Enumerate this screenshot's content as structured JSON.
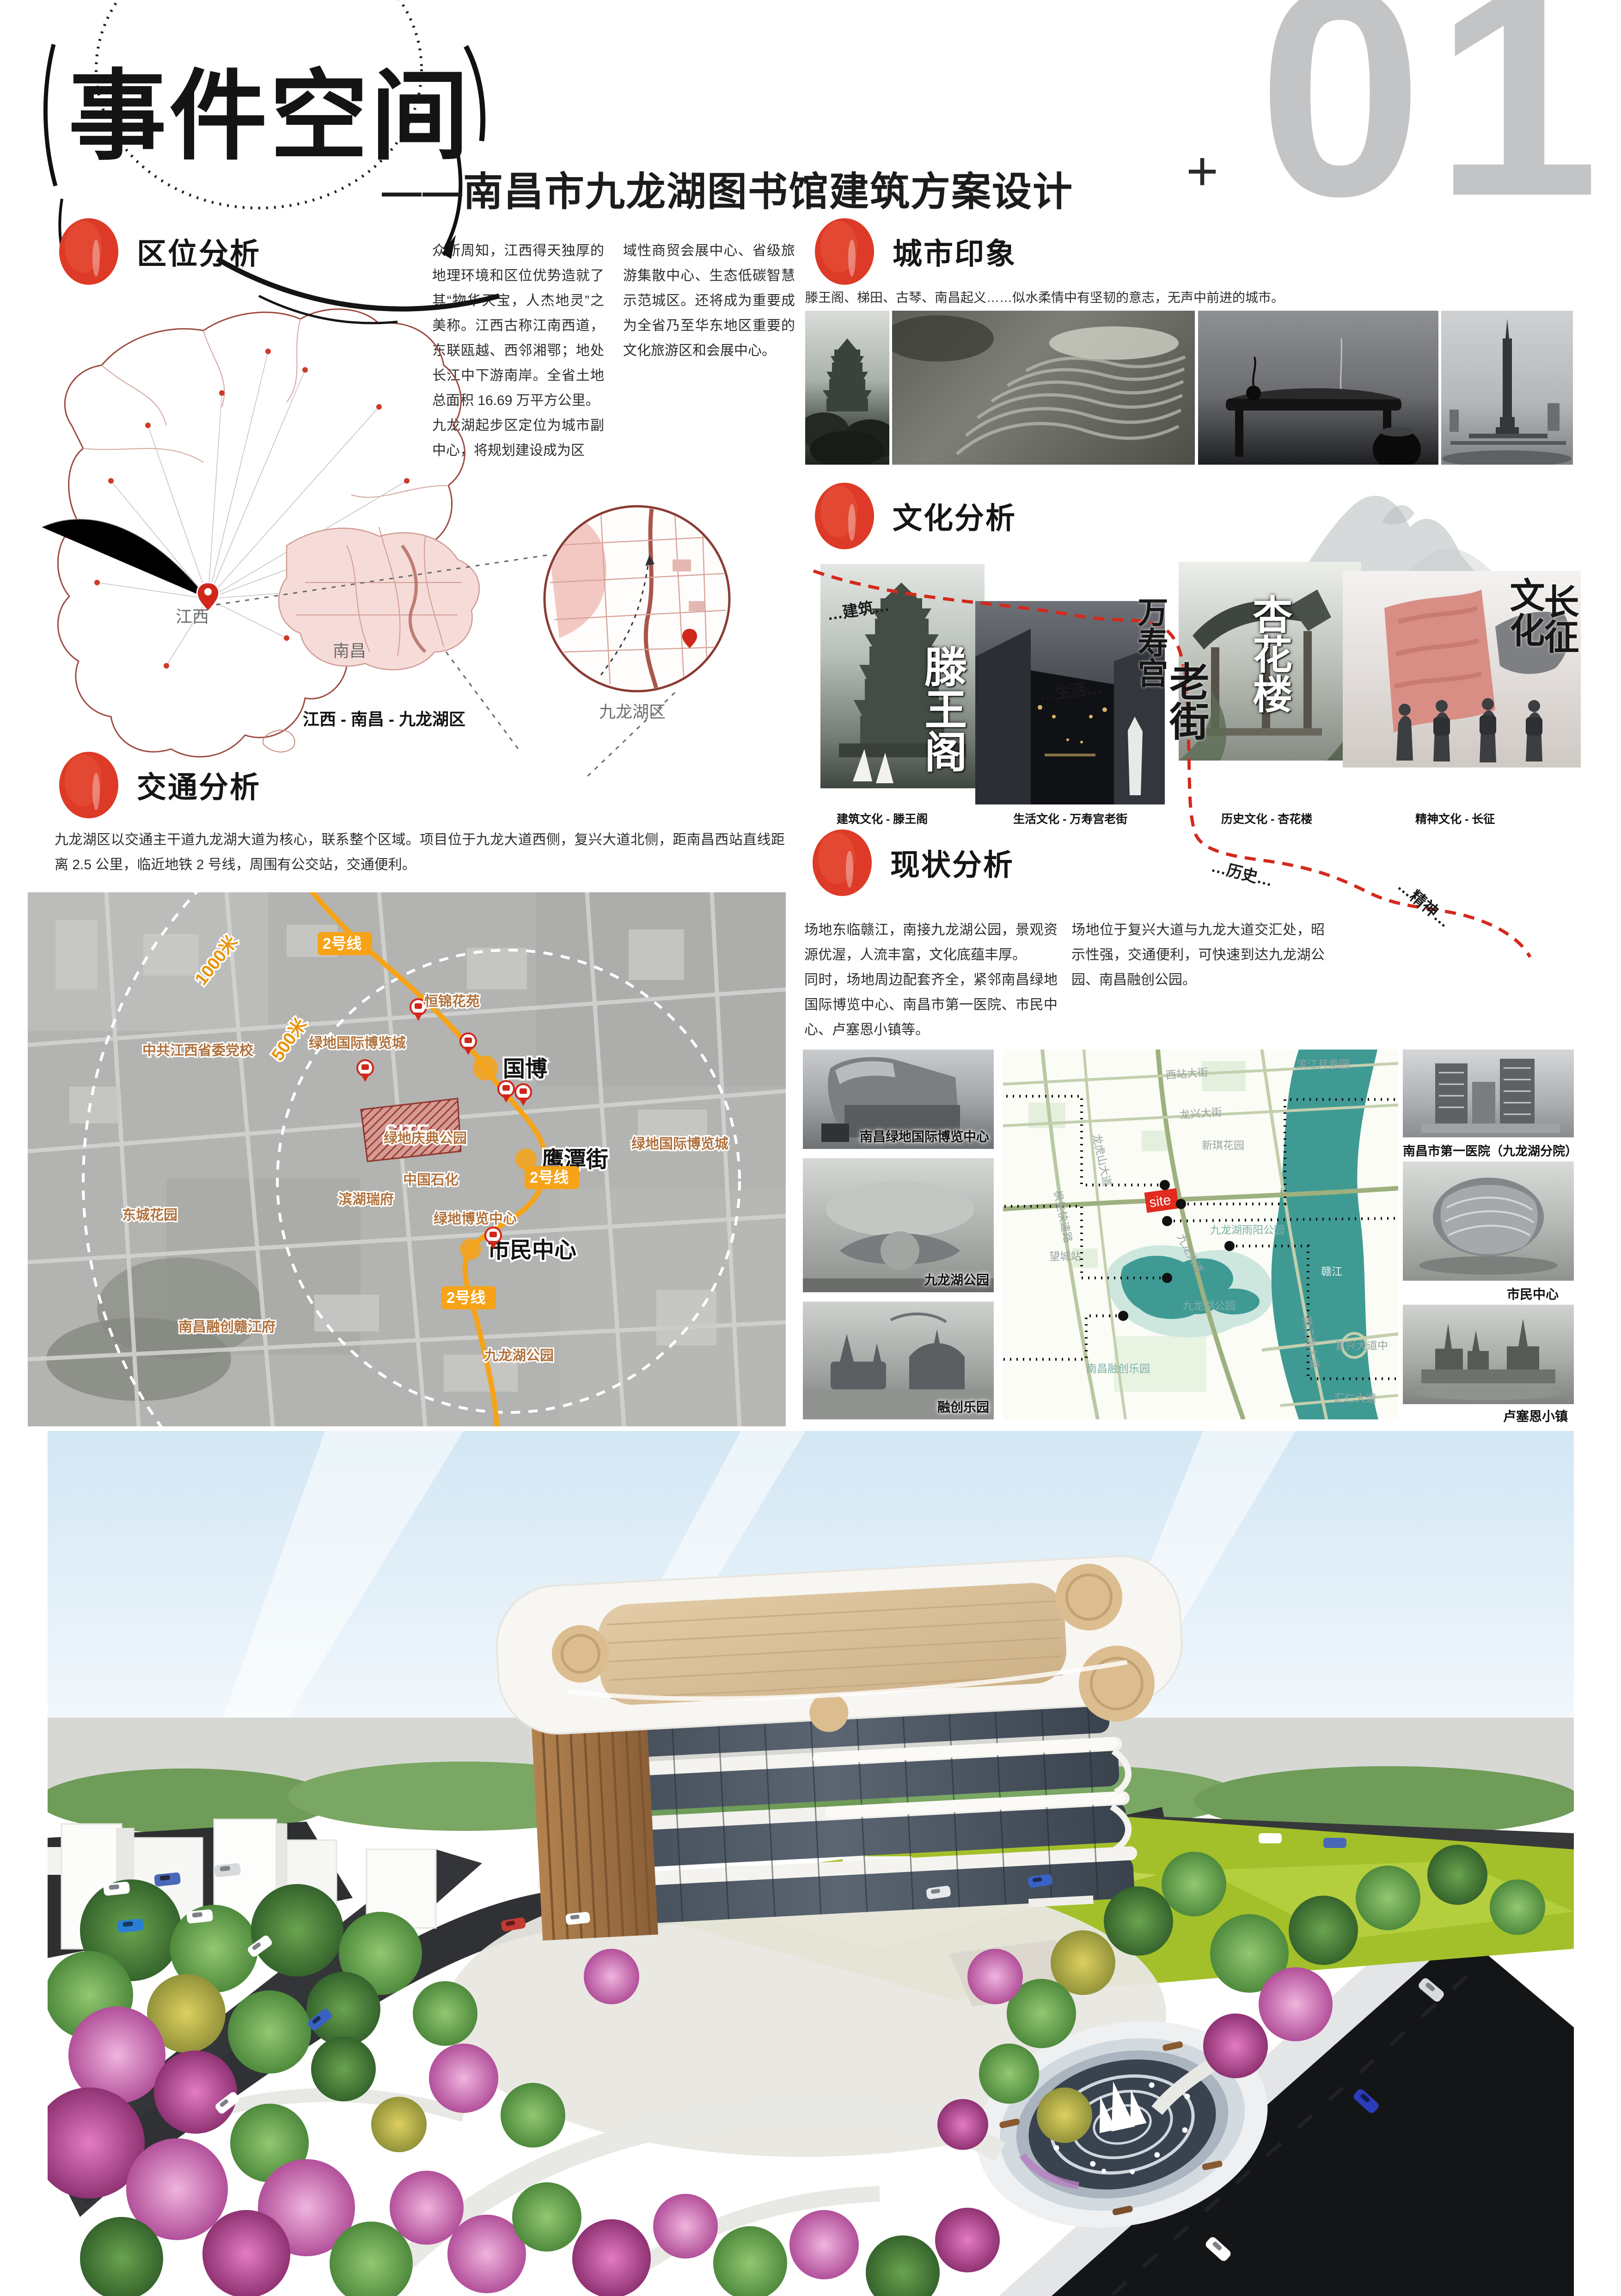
{
  "page": {
    "badge": "01",
    "plus_mark": "+"
  },
  "title": {
    "main": "事件空间",
    "subtitle": "——南昌市九龙湖图书馆建筑方案设计"
  },
  "location": {
    "heading": "区位分析",
    "col1a": "众所周知，江西得天独厚的地理环境和区位优势造就了其“物华天宝，人杰地灵”之美称。江西古称江南西道，东联瓯越、西邻湘鄂；地处长江中下游南岸。全省土地总面积 16.69 万平方公里。",
    "col1b": "九龙湖起步区定位为城市副中心，将规划建设成为区",
    "col2": "域性商贸会展中心、省级旅游集散中心、生态低碳智慧示范城区。还将成为重要成为全省乃至华东地区重要的文化旅游区和会展中心。",
    "map": {
      "jiangxi": "江西",
      "nanchang": "南昌",
      "jiulonghu": "九龙湖区",
      "caption": "江西 - 南昌 - 九龙湖区"
    }
  },
  "impression": {
    "heading": "城市印象",
    "desc": "滕王阁、梯田、古琴、南昌起义……似水柔情中有坚韧的意志，无声中前进的城市。"
  },
  "culture": {
    "heading": "文化分析",
    "flow": {
      "jianzhu": "…建筑…",
      "shenghuo": "…生活…",
      "lishi": "…历史…",
      "jingshen": "…精神…"
    },
    "items": [
      {
        "caption": "建筑文化 - 滕王阁",
        "cal": "滕王阁"
      },
      {
        "caption": "生活文化 - 万寿宫老街",
        "cal_a": "万寿宫",
        "cal_b": "老街"
      },
      {
        "caption": "历史文化 - 杏花楼",
        "cal": "杏花楼"
      },
      {
        "caption": "精神文化 - 长征",
        "cal_a": "文化",
        "cal_b": "长征"
      }
    ]
  },
  "traffic": {
    "heading": "交通分析",
    "para": "九龙湖区以交通主干道九龙湖大道为核心，联系整个区域。项目位于九龙大道西侧，复兴大道北侧，距南昌西站直线距离 2.5 公里，临近地铁 2 号线，周围有公交站，交通便利。",
    "map": {
      "line_badge": "2号线",
      "r1000": "1000米",
      "r500": "500米",
      "site": "SITE",
      "stations": {
        "guobo": "国博",
        "yingtan": "鹰潭街",
        "shimin": "市民中心"
      },
      "places": {
        "dangxiao": "中共江西省委党校",
        "hengjin": "恒锦花苑",
        "qingdian": "绿地庆典公园",
        "bolan_l": "绿地国际博览城",
        "bolan_c": "绿地博览中心",
        "bolan_r": "绿地国际博览城",
        "shihua": "中国石化",
        "binhu": "滨湖瑞府",
        "dongcheng": "东城花园",
        "rongchuangfu": "南昌融创赣江府",
        "jlh_park": "九龙湖公园"
      }
    }
  },
  "status": {
    "heading": "现状分析",
    "col1a": "场地东临赣江，南接九龙湖公园，景观资源优渥，人流丰富，文化底蕴丰厚。",
    "col1b": "同时，场地周边配套齐全，紧邻南昌绿地国际博览中心、南昌市第一医院、市民中心、卢塞恩小镇等。",
    "col2": "场地位于复兴大道与九龙大道交汇处，昭示性强，交通便利，可快速到达九龙湖公园、南昌融创公园。",
    "left_labels": [
      "南昌绿地国际博览中心",
      "九龙湖公园",
      "融创乐园"
    ],
    "right_labels": [
      "南昌市第一医院（九龙湖分院）",
      "市民中心",
      "卢塞恩小镇"
    ],
    "map": {
      "site": "site",
      "labels": {
        "xizhan": "西站大街",
        "longxing": "龙兴大街",
        "binjiang": "滨江月季园",
        "fengsheng": "枫生快速路",
        "longhushan": "龙虎山大道",
        "jiulongdadao": "九龙大道",
        "yuyang": "九龙湖雨阳公园",
        "xinqi": "新琪花园",
        "ganjiang": "赣江",
        "ganjiangnan": "赣江南大道",
        "fuxing": "复兴大道中",
        "huiren": "汇仁大道",
        "jlhpark": "九龙湖公园",
        "rongchuang": "南昌融创乐园",
        "wangcheng": "望城站"
      }
    }
  }
}
